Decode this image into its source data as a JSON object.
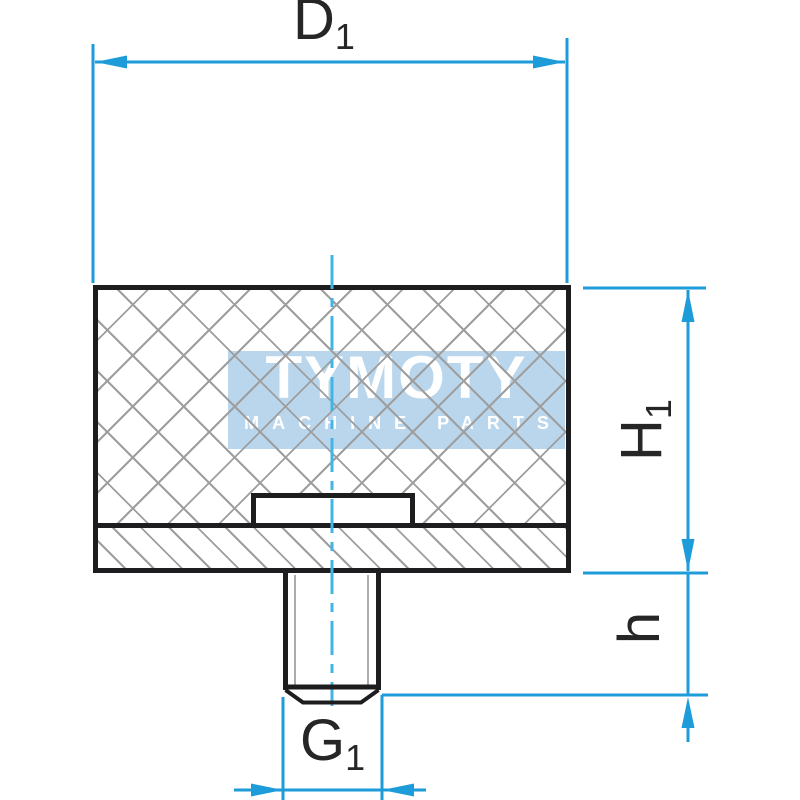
{
  "watermark": {
    "brand": "TYMOTY",
    "tagline": "MACHINE PARTS"
  },
  "dimensions": {
    "diameter": {
      "symbol": "D",
      "subscript": "1"
    },
    "body_height": {
      "symbol": "H",
      "subscript": "1"
    },
    "stud_height": {
      "symbol": "h",
      "subscript": ""
    },
    "thread_size": {
      "symbol": "G",
      "subscript": "1"
    }
  },
  "colors": {
    "background": "#ffffff",
    "dim_line": "#1d9cd9",
    "center_line": "#41b6e6",
    "outline": "#1d1d1f",
    "hatch": "#9e9e9e",
    "thread_inner_line": "#ababab",
    "watermark_bg": "#b9d6ec",
    "watermark_text": "#ffffff",
    "label": "#262626"
  }
}
